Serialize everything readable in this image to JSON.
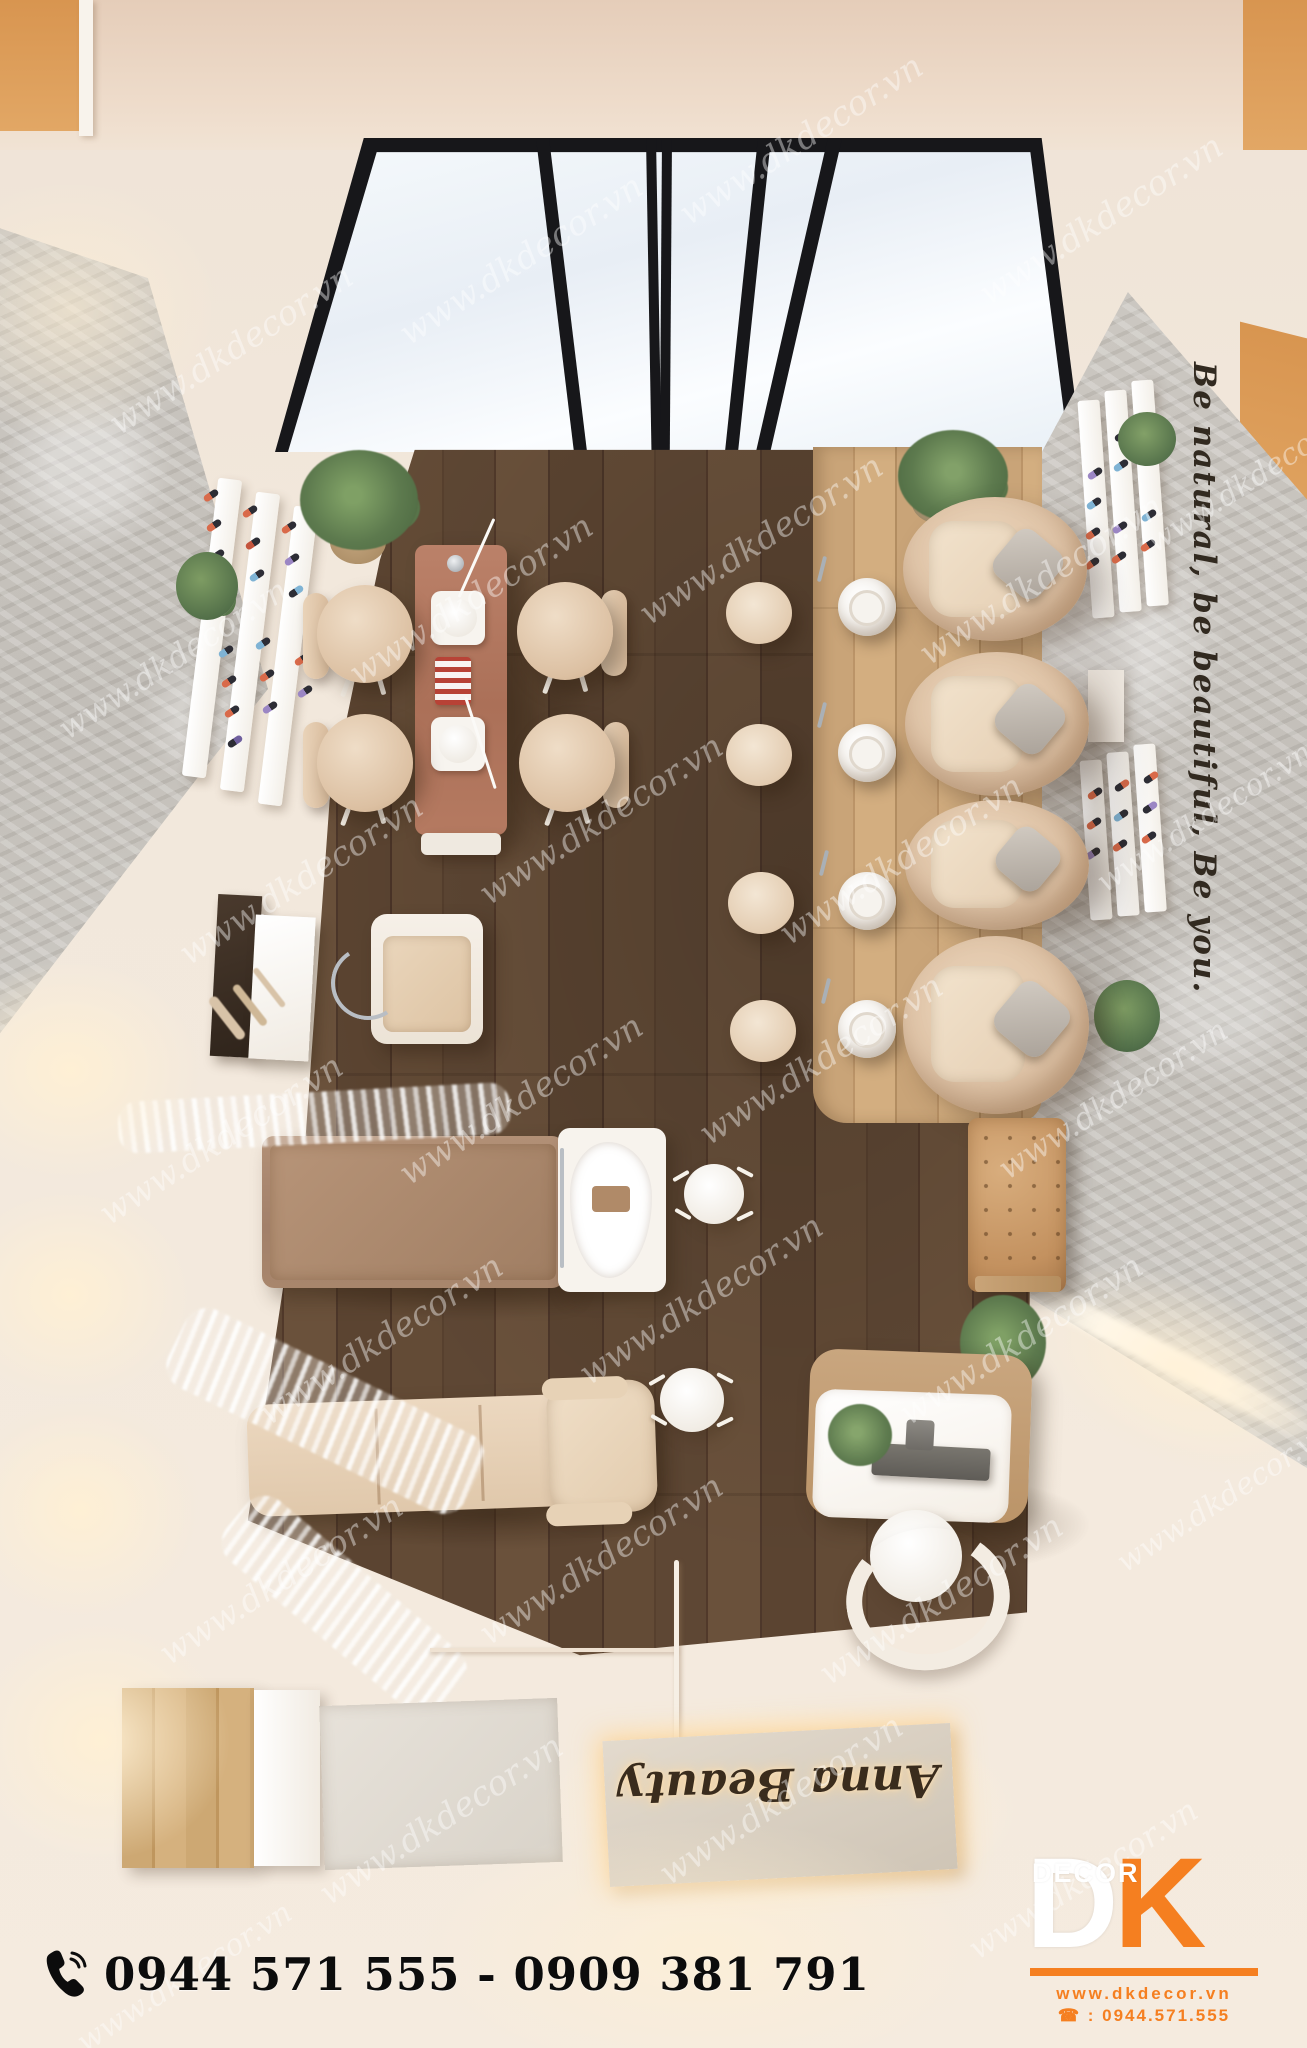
{
  "branding": {
    "watermark": "www.dkdecor.vn",
    "logo": {
      "decor_label": "DECOR",
      "letter_d": "D",
      "letter_k": "K",
      "website": "www.dkdecor.vn",
      "hotline": "☎ : 0944.571.555",
      "accent_color": "#f57f20"
    },
    "phone_banner": {
      "icon": "phone-icon",
      "numbers": "0944 571 555 - 0909 381 791"
    }
  },
  "scene": {
    "wall_quote": "Be natural, be beautiful, Be you.",
    "floor_sign": "Anna Beauty"
  },
  "colors": {
    "cream_wall": "#f1e7db",
    "ceiling": "#e9d5c4",
    "corner_wood": "#dd9c58",
    "dark_floor": "#5a4330",
    "light_platform": "#c9a478",
    "stone": "#c9c5bf",
    "terracotta_table": "#b5755d",
    "beige_furniture": "#e3cbb2",
    "taupe_bed": "#a98a72",
    "tufted_ottoman": "#c89a6d",
    "plant_green": "#5d7a4e",
    "accent_orange": "#f57f20"
  }
}
